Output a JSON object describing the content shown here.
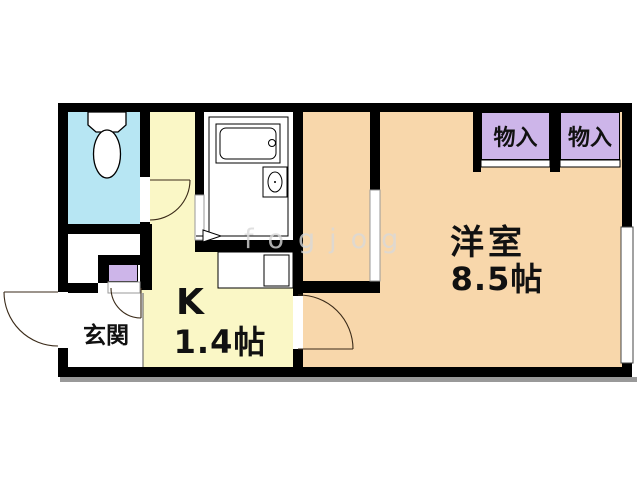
{
  "plan": {
    "type": "floorplan",
    "western_room": {
      "name": "洋室",
      "size": "8.5帖"
    },
    "kitchen": {
      "name": "K",
      "size": "1.4帖"
    },
    "entrance": {
      "name": "玄関"
    },
    "storage_left": {
      "name": "物入"
    },
    "storage_right": {
      "name": "物入"
    },
    "watermark": "fogjog",
    "fixtures": [
      "toilet-icon",
      "bathtub-icon",
      "bath-sink-icon",
      "kitchen-sink-icon",
      "door-swing-icon",
      "folding-door-icon",
      "window-strip",
      "sliding-closet-doors"
    ],
    "colors": {
      "wall": "#000000",
      "western_room_fill": "#F8D7AB",
      "kitchen_fill": "#FAF7C6",
      "toilet_fill": "#B7E6F3",
      "storage_fill": "#CDB5E9",
      "bathroom_fill": "#FFFFFF",
      "entrance_fill": "#FFFFFF",
      "shadow": "#999999",
      "label_text": "#111111"
    }
  }
}
